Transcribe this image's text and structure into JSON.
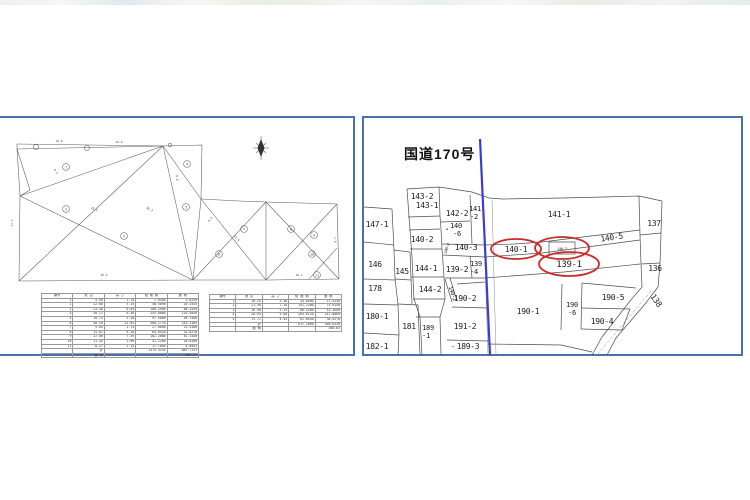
{
  "colors": {
    "highlight_red": "#cc2b2b",
    "road_blue": "#3d3dcc",
    "panel_border_blue": "#4a71ad",
    "drawing_line_gray": "#5a5a5a"
  },
  "left_panel": {
    "type_note": "survey triangulation plot with area calculation tables",
    "circled_points": [
      {
        "t": "1",
        "x": 67,
        "y": 49
      },
      {
        "t": "2",
        "x": 67,
        "y": 91
      },
      {
        "t": "3",
        "x": 125,
        "y": 118
      },
      {
        "t": "4",
        "x": 188,
        "y": 46
      },
      {
        "t": "5",
        "x": 187,
        "y": 89
      },
      {
        "t": "6",
        "x": 220,
        "y": 136
      },
      {
        "t": "7",
        "x": 245,
        "y": 111
      },
      {
        "t": "8",
        "x": 292,
        "y": 111
      },
      {
        "t": "9",
        "x": 315,
        "y": 117
      },
      {
        "t": "10",
        "x": 313,
        "y": 136
      },
      {
        "t": "11",
        "x": 318,
        "y": 157
      }
    ],
    "dim_labels": [
      {
        "t": "12.8",
        "x": 60,
        "y": 24,
        "r": 0
      },
      {
        "t": "23.4",
        "x": 120,
        "y": 25,
        "r": 0
      },
      {
        "t": "9.3",
        "x": 56,
        "y": 54,
        "r": 55
      },
      {
        "t": "25.1",
        "x": 95,
        "y": 92,
        "r": 20
      },
      {
        "t": "11.2",
        "x": 14,
        "y": 105,
        "r": -90
      },
      {
        "t": "30.2",
        "x": 105,
        "y": 158,
        "r": 0
      },
      {
        "t": "8.6",
        "x": 177,
        "y": 60,
        "r": 85
      },
      {
        "t": "18.3",
        "x": 150,
        "y": 92,
        "r": 28
      },
      {
        "t": "15.4",
        "x": 237,
        "y": 121,
        "r": 45
      },
      {
        "t": "10.1",
        "x": 300,
        "y": 158,
        "r": 0
      },
      {
        "t": "7.9",
        "x": 335,
        "y": 122,
        "r": 85
      },
      {
        "t": "6.2",
        "x": 212,
        "y": 102,
        "r": -52
      }
    ],
    "table1": {
      "headers": [
        "番号",
        "底 辺",
        "高 さ",
        "倍 面 積",
        "面 積"
      ],
      "rows": [
        [
          "1",
          "4.50",
          "1.70",
          "7.6500",
          "3.8250"
        ],
        [
          "2",
          "12.86",
          "3.15",
          "40.5090",
          "20.2545"
        ],
        [
          "3",
          "23.40",
          "6.85",
          "160.2900",
          "80.1450"
        ],
        [
          "4",
          "30.12",
          "8.40",
          "253.0080",
          "126.5040"
        ],
        [
          "5",
          "18.75",
          "5.20",
          "97.5000",
          "48.7500"
        ],
        [
          "6",
          "40.18",
          "12.65",
          "508.2770",
          "254.1385"
        ],
        [
          "7",
          "9.84",
          "2.75",
          "27.0600",
          "13.5300"
        ],
        [
          "8",
          "15.62",
          "4.10",
          "64.0420",
          "32.0210"
        ],
        [
          "9",
          "22.08",
          "7.35",
          "162.2880",
          "81.1440"
        ],
        [
          "10",
          "11.45",
          "3.60",
          "41.2200",
          "20.6100"
        ],
        [
          "11",
          "8.27",
          "2.15",
          "17.7805",
          "8.8903"
        ],
        [
          "",
          "計",
          "",
          "1379.4245",
          "689.7123"
        ],
        [
          "",
          "面 積",
          "",
          "",
          "689.71"
        ]
      ]
    },
    "table2": {
      "headers": [
        "番号",
        "底 辺",
        "高 さ",
        "倍 面 積",
        "面 積"
      ],
      "rows": [
        [
          "1",
          "10.25",
          "3.40",
          "34.8500",
          "17.4250"
        ],
        [
          "2",
          "21.30",
          "7.10",
          "151.2300",
          "75.6150"
        ],
        [
          "3",
          "16.48",
          "5.25",
          "86.5200",
          "43.2600"
        ],
        [
          "4",
          "28.94",
          "9.80",
          "283.6120",
          "141.8060"
        ],
        [
          "5",
          "13.72",
          "4.45",
          "61.0540",
          "30.5270"
        ],
        [
          "",
          "計",
          "",
          "617.2660",
          "308.6330"
        ],
        [
          "",
          "面 積",
          "",
          "",
          "308.63"
        ]
      ]
    }
  },
  "right_panel": {
    "road_label": "国道170号",
    "labels": [
      {
        "t": "143-2",
        "x": 58,
        "y": 81,
        "fs": 8,
        "n": "parcel-label-143-2"
      },
      {
        "t": "143-1",
        "x": 63,
        "y": 90,
        "fs": 8,
        "n": "parcel-label-143-1"
      },
      {
        "t": "142-2",
        "x": 93,
        "y": 98,
        "fs": 8,
        "n": "parcel-label-142-2"
      },
      {
        "t": "141",
        "x": 111,
        "y": 93,
        "fs": 7,
        "n": "parcel-label-141-2"
      },
      {
        "t": "-2",
        "x": 110,
        "y": 101,
        "fs": 7,
        "n": "parcel-label-141-2b"
      },
      {
        "t": "140",
        "x": 92,
        "y": 110,
        "fs": 7,
        "n": "parcel-label-140-6"
      },
      {
        "t": "-6",
        "x": 93,
        "y": 118,
        "fs": 7,
        "n": "parcel-label-140-6b"
      },
      {
        "t": "•",
        "x": 83,
        "y": 113,
        "fs": 5,
        "n": "survey-dot"
      },
      {
        "t": "147-1",
        "x": 13,
        "y": 109,
        "fs": 8,
        "n": "parcel-label-147-1"
      },
      {
        "t": "140-2",
        "x": 58,
        "y": 124,
        "fs": 8,
        "n": "parcel-label-140-2"
      },
      {
        "t": "140-3",
        "x": 102,
        "y": 132,
        "fs": 8,
        "n": "parcel-label-140-3"
      },
      {
        "t": "140-4",
        "x": 84,
        "y": 131,
        "fs": 4,
        "r": -70,
        "n": "parcel-label-140-4"
      },
      {
        "t": "140-1",
        "x": 152,
        "y": 134,
        "fs": 8,
        "n": "parcel-label-140-1"
      },
      {
        "t": "140-7",
        "x": 198,
        "y": 132,
        "fs": 3.6,
        "n": "parcel-label-140-7"
      },
      {
        "t": "140-5",
        "x": 248,
        "y": 122,
        "fs": 8,
        "r": -8,
        "n": "parcel-label-140-5"
      },
      {
        "t": "141-1",
        "x": 195,
        "y": 99,
        "fs": 8,
        "n": "parcel-label-141-1"
      },
      {
        "t": "137",
        "x": 290,
        "y": 108,
        "fs": 8,
        "n": "parcel-label-137"
      },
      {
        "t": "146",
        "x": 11,
        "y": 149,
        "fs": 8,
        "n": "parcel-label-146"
      },
      {
        "t": "145",
        "x": 38,
        "y": 156,
        "fs": 8,
        "n": "parcel-label-145"
      },
      {
        "t": "144-1",
        "x": 62,
        "y": 153,
        "fs": 8,
        "n": "parcel-label-144-1"
      },
      {
        "t": "139-2",
        "x": 93,
        "y": 154,
        "fs": 8,
        "n": "parcel-label-139-2"
      },
      {
        "t": "139",
        "x": 112,
        "y": 148,
        "fs": 7,
        "n": "parcel-label-139-4"
      },
      {
        "t": "-4",
        "x": 110,
        "y": 156,
        "fs": 7,
        "n": "parcel-label-139-4b"
      },
      {
        "t": "139-1",
        "x": 205,
        "y": 149,
        "fs": 9,
        "n": "parcel-label-139-1"
      },
      {
        "t": "136",
        "x": 291,
        "y": 153,
        "fs": 8,
        "n": "parcel-label-136"
      },
      {
        "t": "178",
        "x": 11,
        "y": 173,
        "fs": 8,
        "n": "parcel-label-178"
      },
      {
        "t": "144-2",
        "x": 66,
        "y": 174,
        "fs": 8,
        "n": "parcel-label-144-2"
      },
      {
        "t": "140-2",
        "x": 87,
        "y": 176,
        "fs": 5.5,
        "r": 72,
        "n": "parcel-label-140-2-strip"
      },
      {
        "t": "190-2",
        "x": 101,
        "y": 183,
        "fs": 8,
        "n": "parcel-label-190-2"
      },
      {
        "t": "190-1",
        "x": 164,
        "y": 196,
        "fs": 8,
        "n": "parcel-label-190-1"
      },
      {
        "t": "180-1",
        "x": 13,
        "y": 201,
        "fs": 8,
        "n": "parcel-label-180-1"
      },
      {
        "t": "181",
        "x": 45,
        "y": 211,
        "fs": 8,
        "n": "parcel-label-181"
      },
      {
        "t": "189",
        "x": 64,
        "y": 212,
        "fs": 7,
        "n": "parcel-label-189-1"
      },
      {
        "t": "-1",
        "x": 62,
        "y": 220,
        "fs": 7,
        "n": "parcel-label-189-1b"
      },
      {
        "t": "191-2",
        "x": 101,
        "y": 211,
        "fs": 8,
        "n": "parcel-label-191-2"
      },
      {
        "t": "190-5",
        "x": 249,
        "y": 182,
        "fs": 8,
        "n": "parcel-label-190-5"
      },
      {
        "t": "190",
        "x": 208,
        "y": 189,
        "fs": 7,
        "n": "parcel-label-190-6"
      },
      {
        "t": "-6",
        "x": 208,
        "y": 197,
        "fs": 7,
        "n": "parcel-label-190-6b"
      },
      {
        "t": "190-4",
        "x": 238,
        "y": 206,
        "fs": 8,
        "n": "parcel-label-190-4"
      },
      {
        "t": "138",
        "x": 290,
        "y": 184,
        "fs": 8,
        "r": 55,
        "n": "parcel-label-138"
      },
      {
        "t": "182-1",
        "x": 13,
        "y": 231,
        "fs": 8,
        "n": "parcel-label-182-1"
      },
      {
        "t": "-",
        "x": 89,
        "y": 231,
        "fs": 7,
        "n": "survey-dash"
      },
      {
        "t": "189-3",
        "x": 104,
        "y": 231,
        "fs": 8,
        "n": "parcel-label-189-3"
      }
    ],
    "highlight_ellipses": [
      {
        "cx": 152,
        "cy": 131,
        "rx": 25,
        "ry": 10,
        "n": "highlight-ellipse-140-1"
      },
      {
        "cx": 198,
        "cy": 130,
        "rx": 27,
        "ry": 11,
        "n": "highlight-ellipse-140-7"
      },
      {
        "cx": 205,
        "cy": 146,
        "rx": 30,
        "ry": 12,
        "n": "highlight-ellipse-139-1"
      }
    ]
  }
}
